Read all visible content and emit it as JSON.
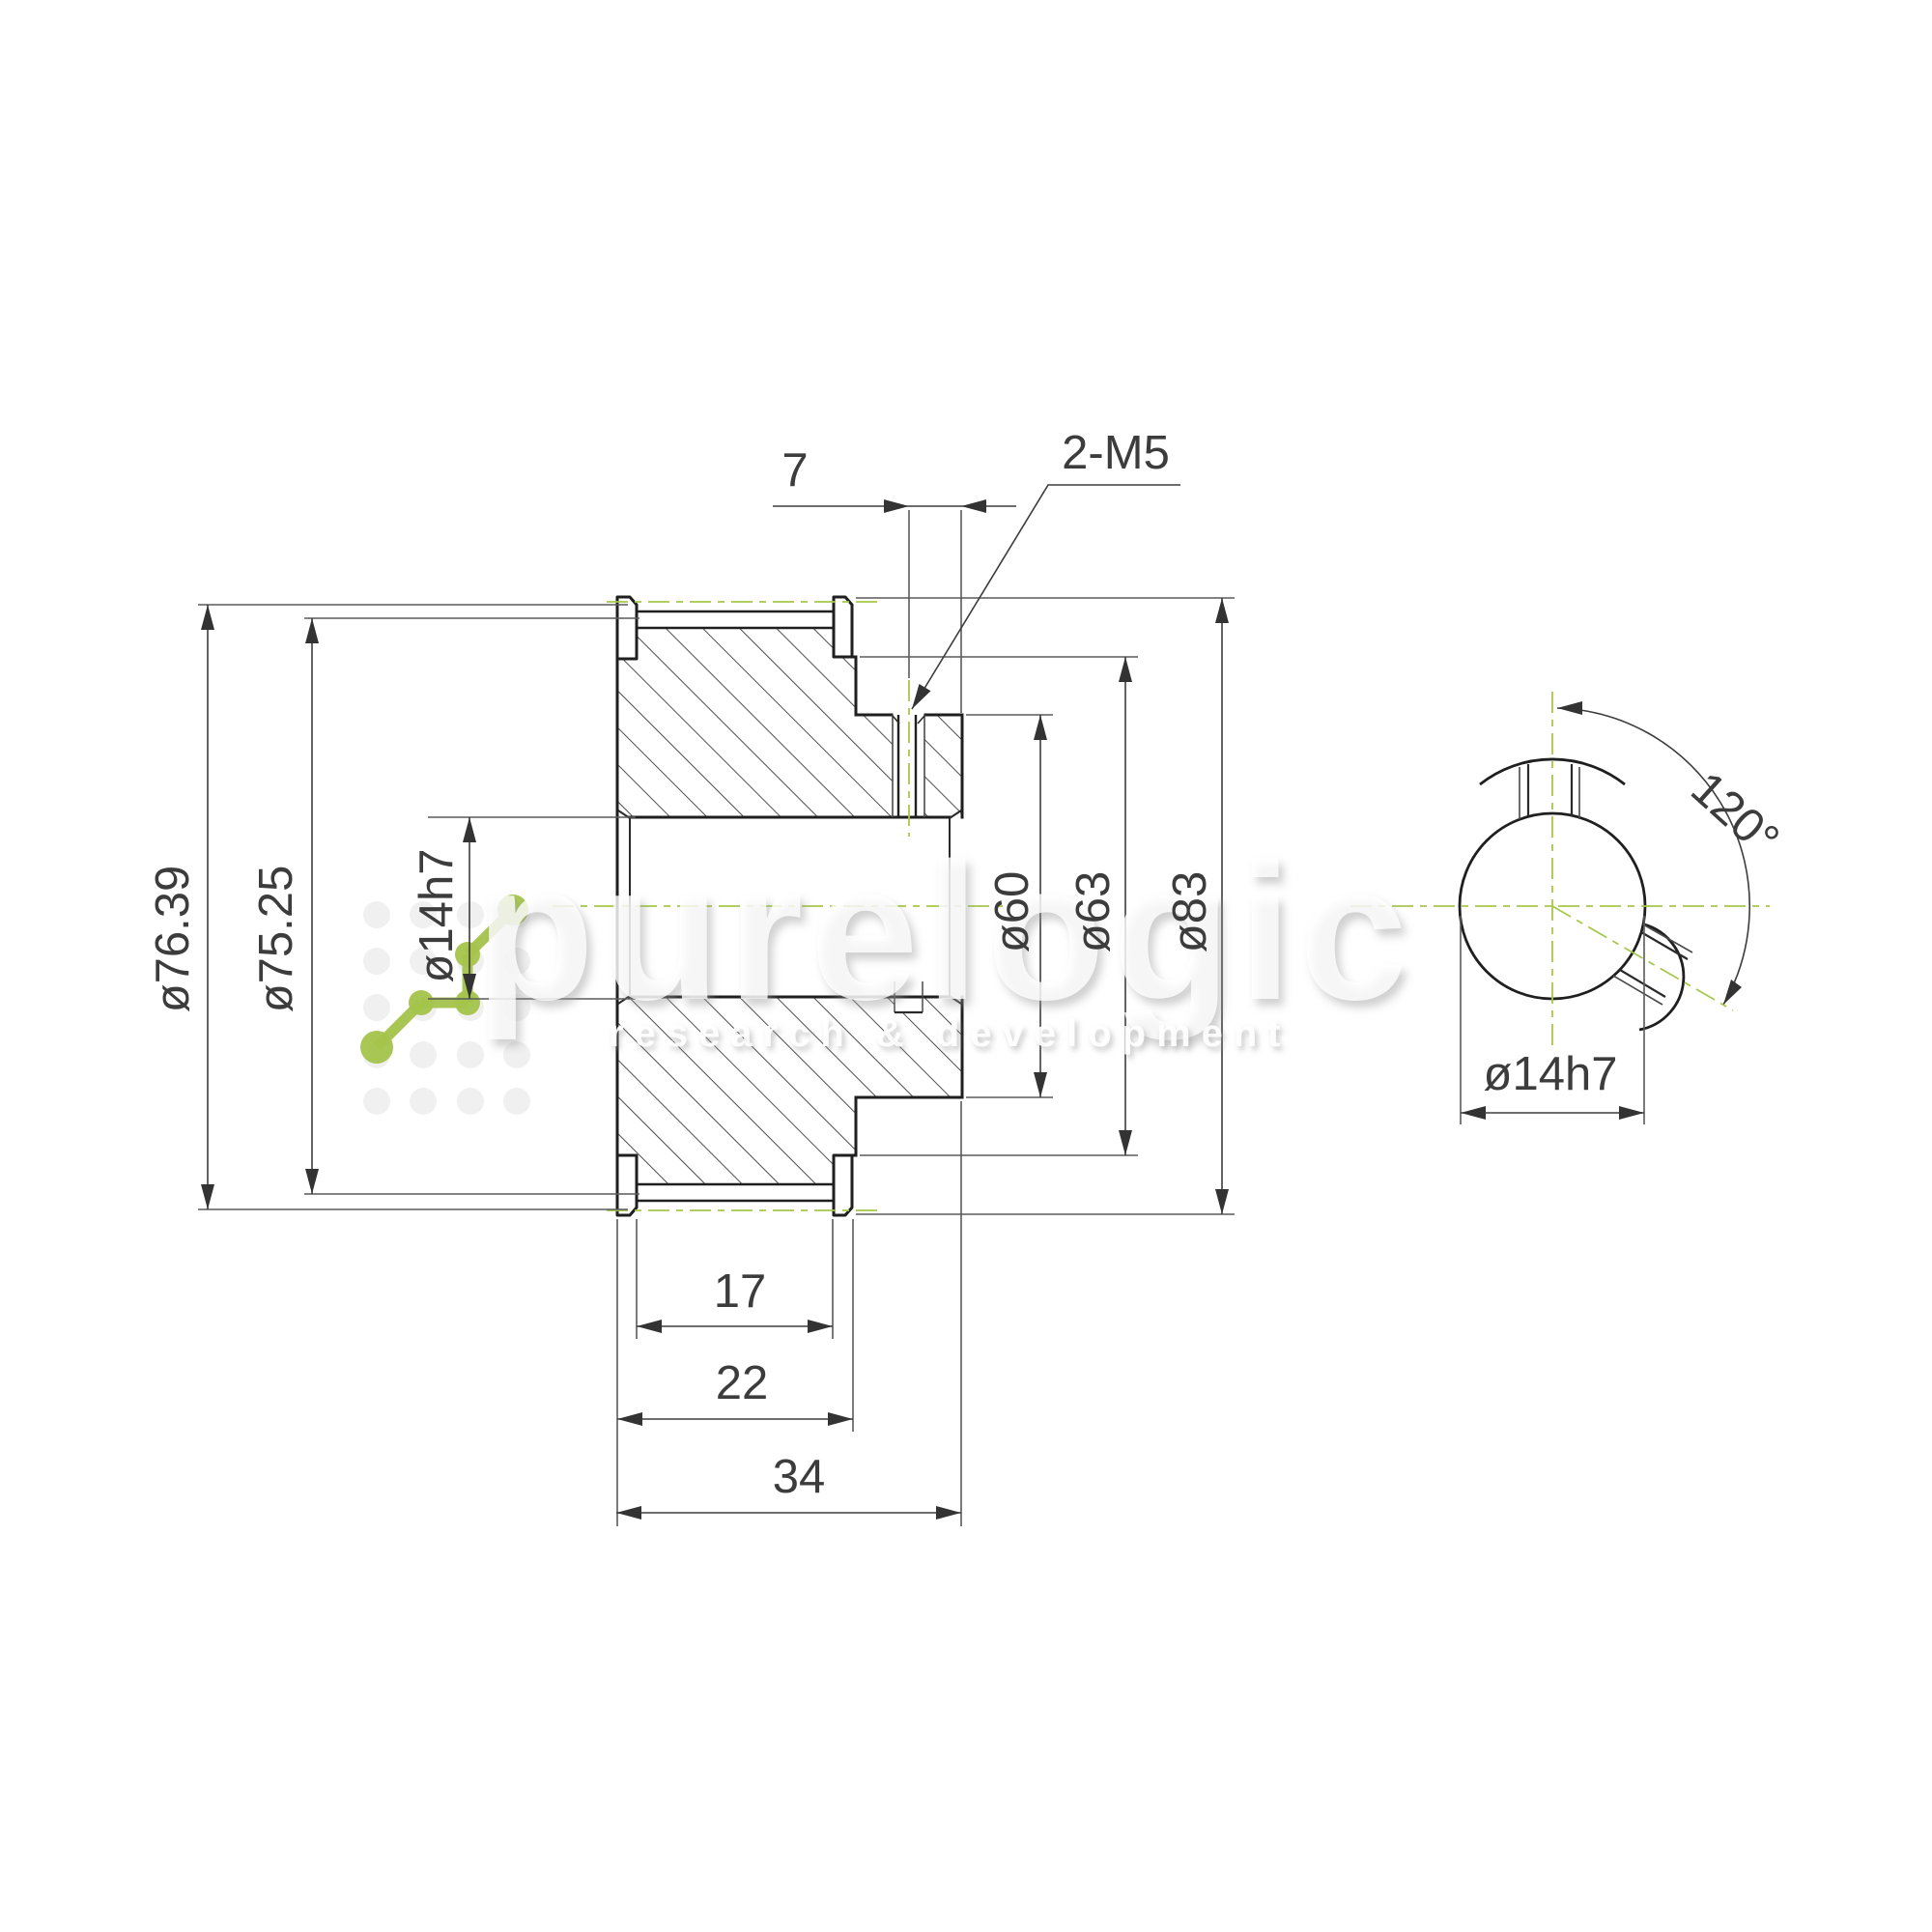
{
  "drawing_type": "timing pulley technical drawing",
  "dims": {
    "pitch": "ø76.39",
    "outer": "ø75.25",
    "bore": "ø14h7",
    "hub": "ø60",
    "shoulder": "ø63",
    "flange": "ø83",
    "hole_offset": "7",
    "thread": "2-M5",
    "belt_width": "17",
    "flange_width": "22",
    "total_width": "34",
    "bore_side": "ø14h7",
    "hole_angle": "120°"
  },
  "watermark": {
    "brand": "purelogic",
    "tagline": "research & development"
  },
  "colors": {
    "outline": "#1f1f1f",
    "dimension": "#3d3d3d",
    "extension": "#5a5a5a",
    "hatch": "#3a3a3a",
    "centerline_green": "#a7c84b",
    "logo_green": "#a5c44c",
    "dot_grid": "#f2f2f2",
    "background": "#ffffff"
  }
}
